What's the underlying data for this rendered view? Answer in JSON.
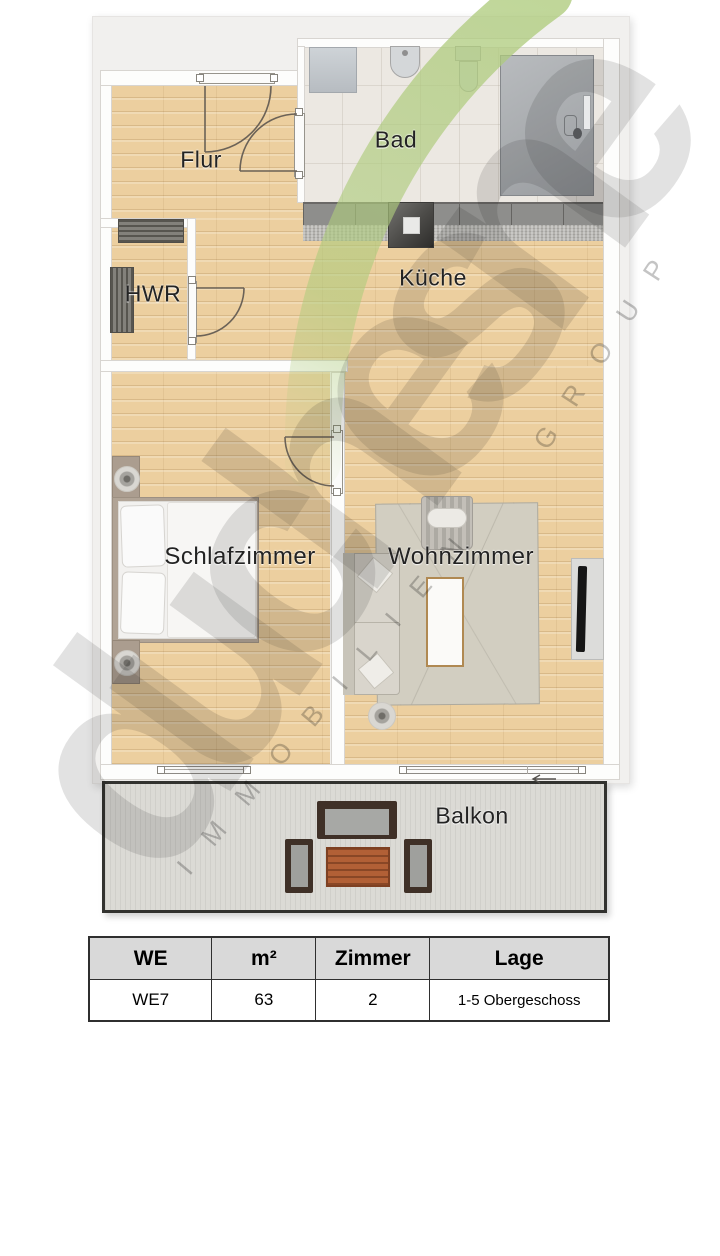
{
  "plan": {
    "rooms": [
      {
        "id": "flur",
        "label": "Flur"
      },
      {
        "id": "bad",
        "label": "Bad"
      },
      {
        "id": "hwr",
        "label": "HWR"
      },
      {
        "id": "kueche",
        "label": "Küche"
      },
      {
        "id": "schlafzimmer",
        "label": "Schlafzimmer"
      },
      {
        "id": "wohnzimmer",
        "label": "Wohnzimmer"
      },
      {
        "id": "balkon",
        "label": "Balkon"
      }
    ],
    "watermark": {
      "brand": "du chesne",
      "line1": "IMMOBILIEN",
      "line2": "GROUP"
    }
  },
  "table": {
    "headers": [
      "WE",
      "m²",
      "Zimmer",
      "Lage"
    ],
    "rows": [
      [
        "WE7",
        "63",
        "2",
        "1-5 Obergeschoss"
      ]
    ]
  },
  "colors": {
    "canvas": "#f1f0ee",
    "wood": "#eccf9f",
    "tile": "#ece8e2",
    "balcony_floor": "#dbdad5",
    "accent_green": "#aecb7c",
    "watermark_gray": "#c9c9c9",
    "table_header_bg": "#d9d9d9"
  }
}
